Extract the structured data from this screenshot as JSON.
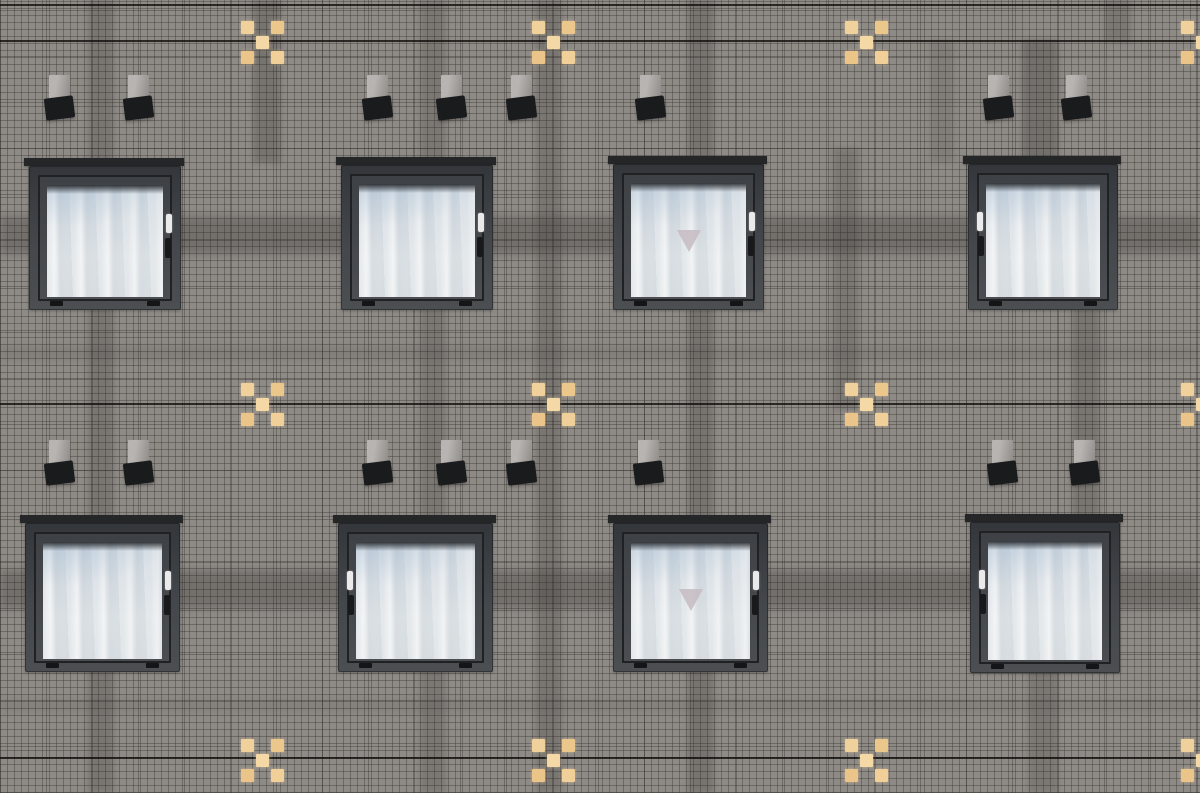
{
  "scene": {
    "description": "Photograph of a dark grey mosaic-tiled building facade: two rows of four square windows with dark frames and white curtains, small paired wall lamps above the windows, decorative yellow tile crosses, and darker panel-joint bands",
    "image_type": "photograph",
    "window_count": 8,
    "lamp_count": 16,
    "cross_count": 12,
    "colors": {
      "facade_base": "#8e8a86",
      "shadow_band": "#2a2825",
      "joint_line": "#141312",
      "lintel": "#242628",
      "sash_gap": "#1f2123",
      "handle_plate": "#e9eae9",
      "handle_grip": "#17191b",
      "lamp_body_light": "#b7b4b1",
      "lamp_body_dark": "#8e8b88",
      "lamp_head": "#1a1b1d",
      "triangle": "#c6bbc2",
      "glass_blue": "#c5cfd9",
      "curtain_white": "#eef1f2"
    },
    "cross_tile_colors": [
      "#f0d09b",
      "#ecc78c",
      "#f4d9a6",
      "#eac488",
      "#f0cf98"
    ]
  },
  "joint_lines": [
    {
      "y": 4
    },
    {
      "y": 40
    },
    {
      "y": 403
    },
    {
      "y": 757
    }
  ],
  "vertical_bands": [
    {
      "x": 88,
      "y0": 0,
      "y1": 793,
      "w": 26,
      "o": 0.2
    },
    {
      "x": 253,
      "y0": 0,
      "y1": 163,
      "w": 28,
      "o": 0.22
    },
    {
      "x": 420,
      "y0": 0,
      "y1": 793,
      "w": 26,
      "o": 0.18
    },
    {
      "x": 536,
      "y0": 0,
      "y1": 793,
      "w": 26,
      "o": 0.2
    },
    {
      "x": 688,
      "y0": 0,
      "y1": 793,
      "w": 26,
      "o": 0.22
    },
    {
      "x": 833,
      "y0": 148,
      "y1": 410,
      "w": 26,
      "o": 0.18
    },
    {
      "x": 930,
      "y0": 40,
      "y1": 163,
      "w": 24,
      "o": 0.12
    },
    {
      "x": 1022,
      "y0": 40,
      "y1": 166,
      "w": 36,
      "o": 0.26
    },
    {
      "x": 1072,
      "y0": 166,
      "y1": 560,
      "w": 28,
      "o": 0.2
    },
    {
      "x": 1028,
      "y0": 630,
      "y1": 793,
      "w": 30,
      "o": 0.18
    },
    {
      "x": 1105,
      "y0": 0,
      "y1": 42,
      "w": 26,
      "o": 0.18
    }
  ],
  "horizontal_bands": [
    {
      "y": 216,
      "h": 38,
      "o": 0.26
    },
    {
      "y": 570,
      "h": 38,
      "o": 0.26
    },
    {
      "y": 346,
      "h": 14,
      "o": 0.12
    },
    {
      "y": 700,
      "h": 12,
      "o": 0.1
    }
  ],
  "crosses": [
    {
      "cx": 262,
      "cy": 42
    },
    {
      "cx": 553,
      "cy": 42
    },
    {
      "cx": 866,
      "cy": 42
    },
    {
      "cx": 1202,
      "cy": 42
    },
    {
      "cx": 262,
      "cy": 404
    },
    {
      "cx": 553,
      "cy": 404
    },
    {
      "cx": 866,
      "cy": 404
    },
    {
      "cx": 1202,
      "cy": 404
    },
    {
      "cx": 262,
      "cy": 760
    },
    {
      "cx": 553,
      "cy": 760
    },
    {
      "cx": 866,
      "cy": 760
    },
    {
      "cx": 1202,
      "cy": 760
    }
  ],
  "lamps": [
    {
      "x": 49,
      "y": 75
    },
    {
      "x": 128,
      "y": 75
    },
    {
      "x": 367,
      "y": 75
    },
    {
      "x": 441,
      "y": 75
    },
    {
      "x": 511,
      "y": 75
    },
    {
      "x": 640,
      "y": 75
    },
    {
      "x": 988,
      "y": 75
    },
    {
      "x": 1066,
      "y": 75
    },
    {
      "x": 49,
      "y": 440
    },
    {
      "x": 128,
      "y": 440
    },
    {
      "x": 367,
      "y": 440
    },
    {
      "x": 441,
      "y": 440
    },
    {
      "x": 511,
      "y": 440
    },
    {
      "x": 638,
      "y": 440
    },
    {
      "x": 992,
      "y": 440
    },
    {
      "x": 1074,
      "y": 440
    }
  ],
  "windows": [
    {
      "x": 29,
      "y": 166,
      "w": 152,
      "h": 144,
      "handle": "right",
      "triangle": false
    },
    {
      "x": 341,
      "y": 165,
      "w": 152,
      "h": 145,
      "handle": "right",
      "triangle": false
    },
    {
      "x": 613,
      "y": 164,
      "w": 151,
      "h": 146,
      "handle": "right",
      "triangle": true
    },
    {
      "x": 968,
      "y": 164,
      "w": 150,
      "h": 146,
      "handle": "left",
      "triangle": false
    },
    {
      "x": 25,
      "y": 523,
      "w": 155,
      "h": 149,
      "handle": "right",
      "triangle": false
    },
    {
      "x": 338,
      "y": 523,
      "w": 155,
      "h": 149,
      "handle": "left",
      "triangle": false
    },
    {
      "x": 613,
      "y": 523,
      "w": 155,
      "h": 149,
      "handle": "right",
      "triangle": true
    },
    {
      "x": 970,
      "y": 522,
      "w": 150,
      "h": 151,
      "handle": "left",
      "triangle": false
    }
  ]
}
